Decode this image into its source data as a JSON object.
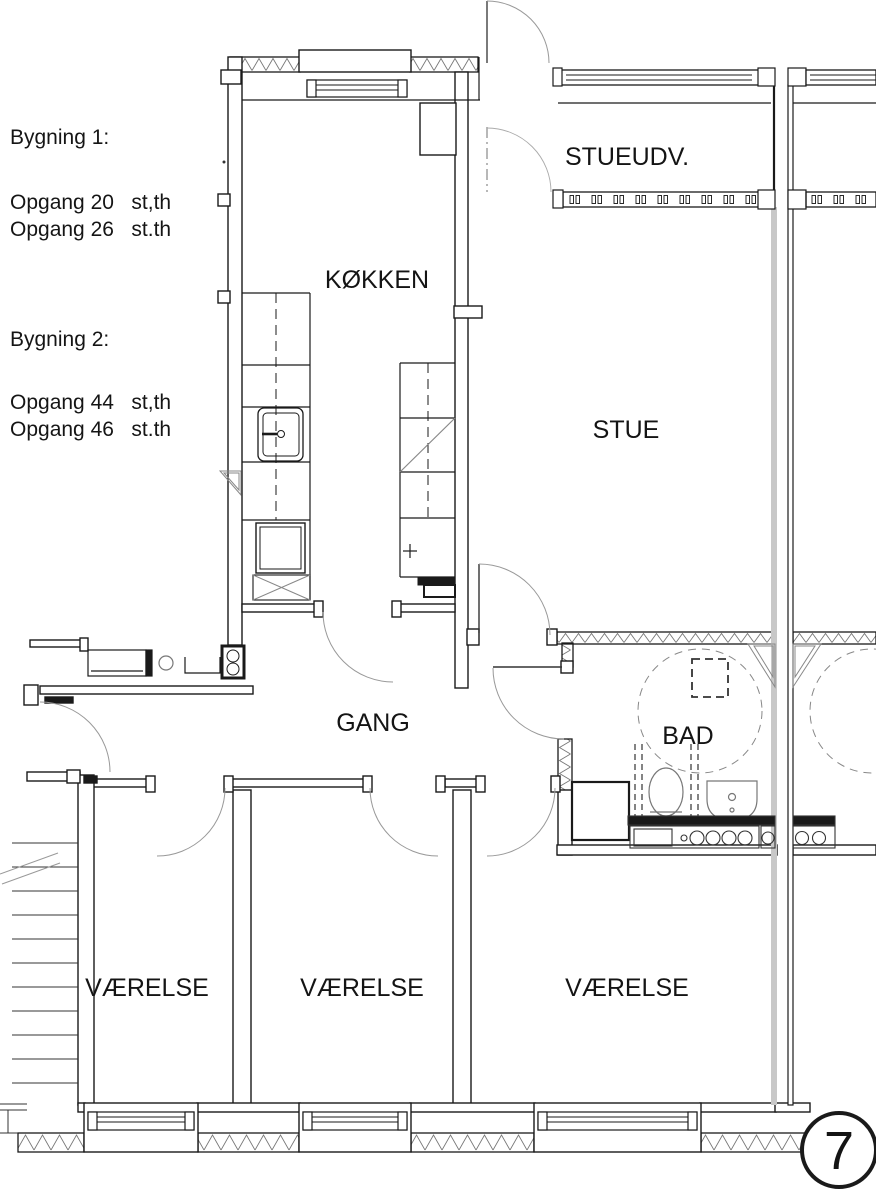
{
  "info": {
    "b1_title": "Bygning 1:",
    "b1_line1": "Opgang 20   st,th",
    "b1_line2": "Opgang 26   st.th",
    "b2_title": "Bygning 2:",
    "b2_line1": "Opgang 44   st,th",
    "b2_line2": "Opgang 46   st.th"
  },
  "rooms": {
    "kitchen": "KØKKEN",
    "living_extension": "STUEUDV.",
    "living_room": "STUE",
    "hallway": "GANG",
    "bathroom": "BAD",
    "room1": "VÆRELSE",
    "room2": "VÆRELSE",
    "room3": "VÆRELSE"
  },
  "page_number": "7",
  "colors": {
    "wall": "#1a1a1a",
    "hatch": "#777777",
    "door_arc": "#999999",
    "party_wall_gray": "#c8c8c8",
    "background": "#ffffff"
  }
}
